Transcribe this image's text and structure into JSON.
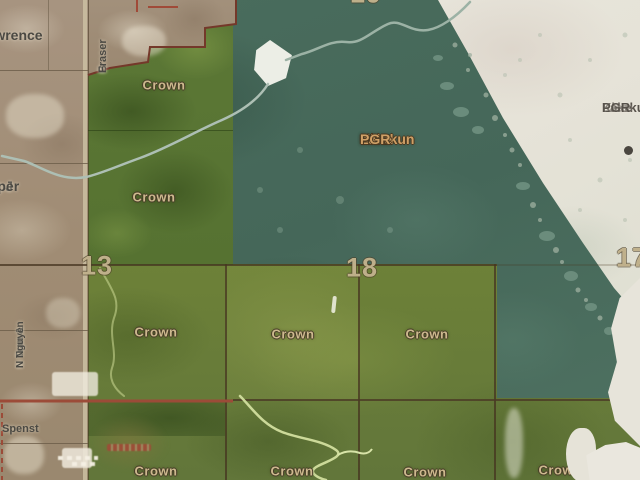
{
  "map": {
    "title_labels": {
      "kleskun_main_line1": "Kleskun",
      "kleskun_main_line2": "Lake",
      "kleskun_main_line3": "PGR",
      "kleskun_right_line1": "Kleskun",
      "kleskun_right_line2": "Lake",
      "kleskun_right_line3": "PGR"
    },
    "section_numbers": {
      "top": "19",
      "left": "13",
      "center": "18",
      "right": "17"
    },
    "owner_labels": {
      "lawrence_initial": "G",
      "lawrence_surname": "Lawrence",
      "fraser_initial": "B",
      "fraser_surname": "Fraser",
      "jasper_initials": "W & J",
      "jasper_surname": "Jasper",
      "tran_line1": "N Tran &",
      "tran_line2": "N Nguyen",
      "spenst": "Spenst"
    },
    "crown_labels": [
      "Crown",
      "Crown",
      "Crown",
      "Crown",
      "Crown",
      "Crown",
      "Crown",
      "Crown",
      "Crown"
    ],
    "colors": {
      "farmland": "#a08c74",
      "crown_green": "#6d8138",
      "reserve_teal": "#47695b",
      "dry_lakebed": "#e7e4da",
      "label_tan": "#cdb98e",
      "road_red": "#9c4b38"
    }
  }
}
